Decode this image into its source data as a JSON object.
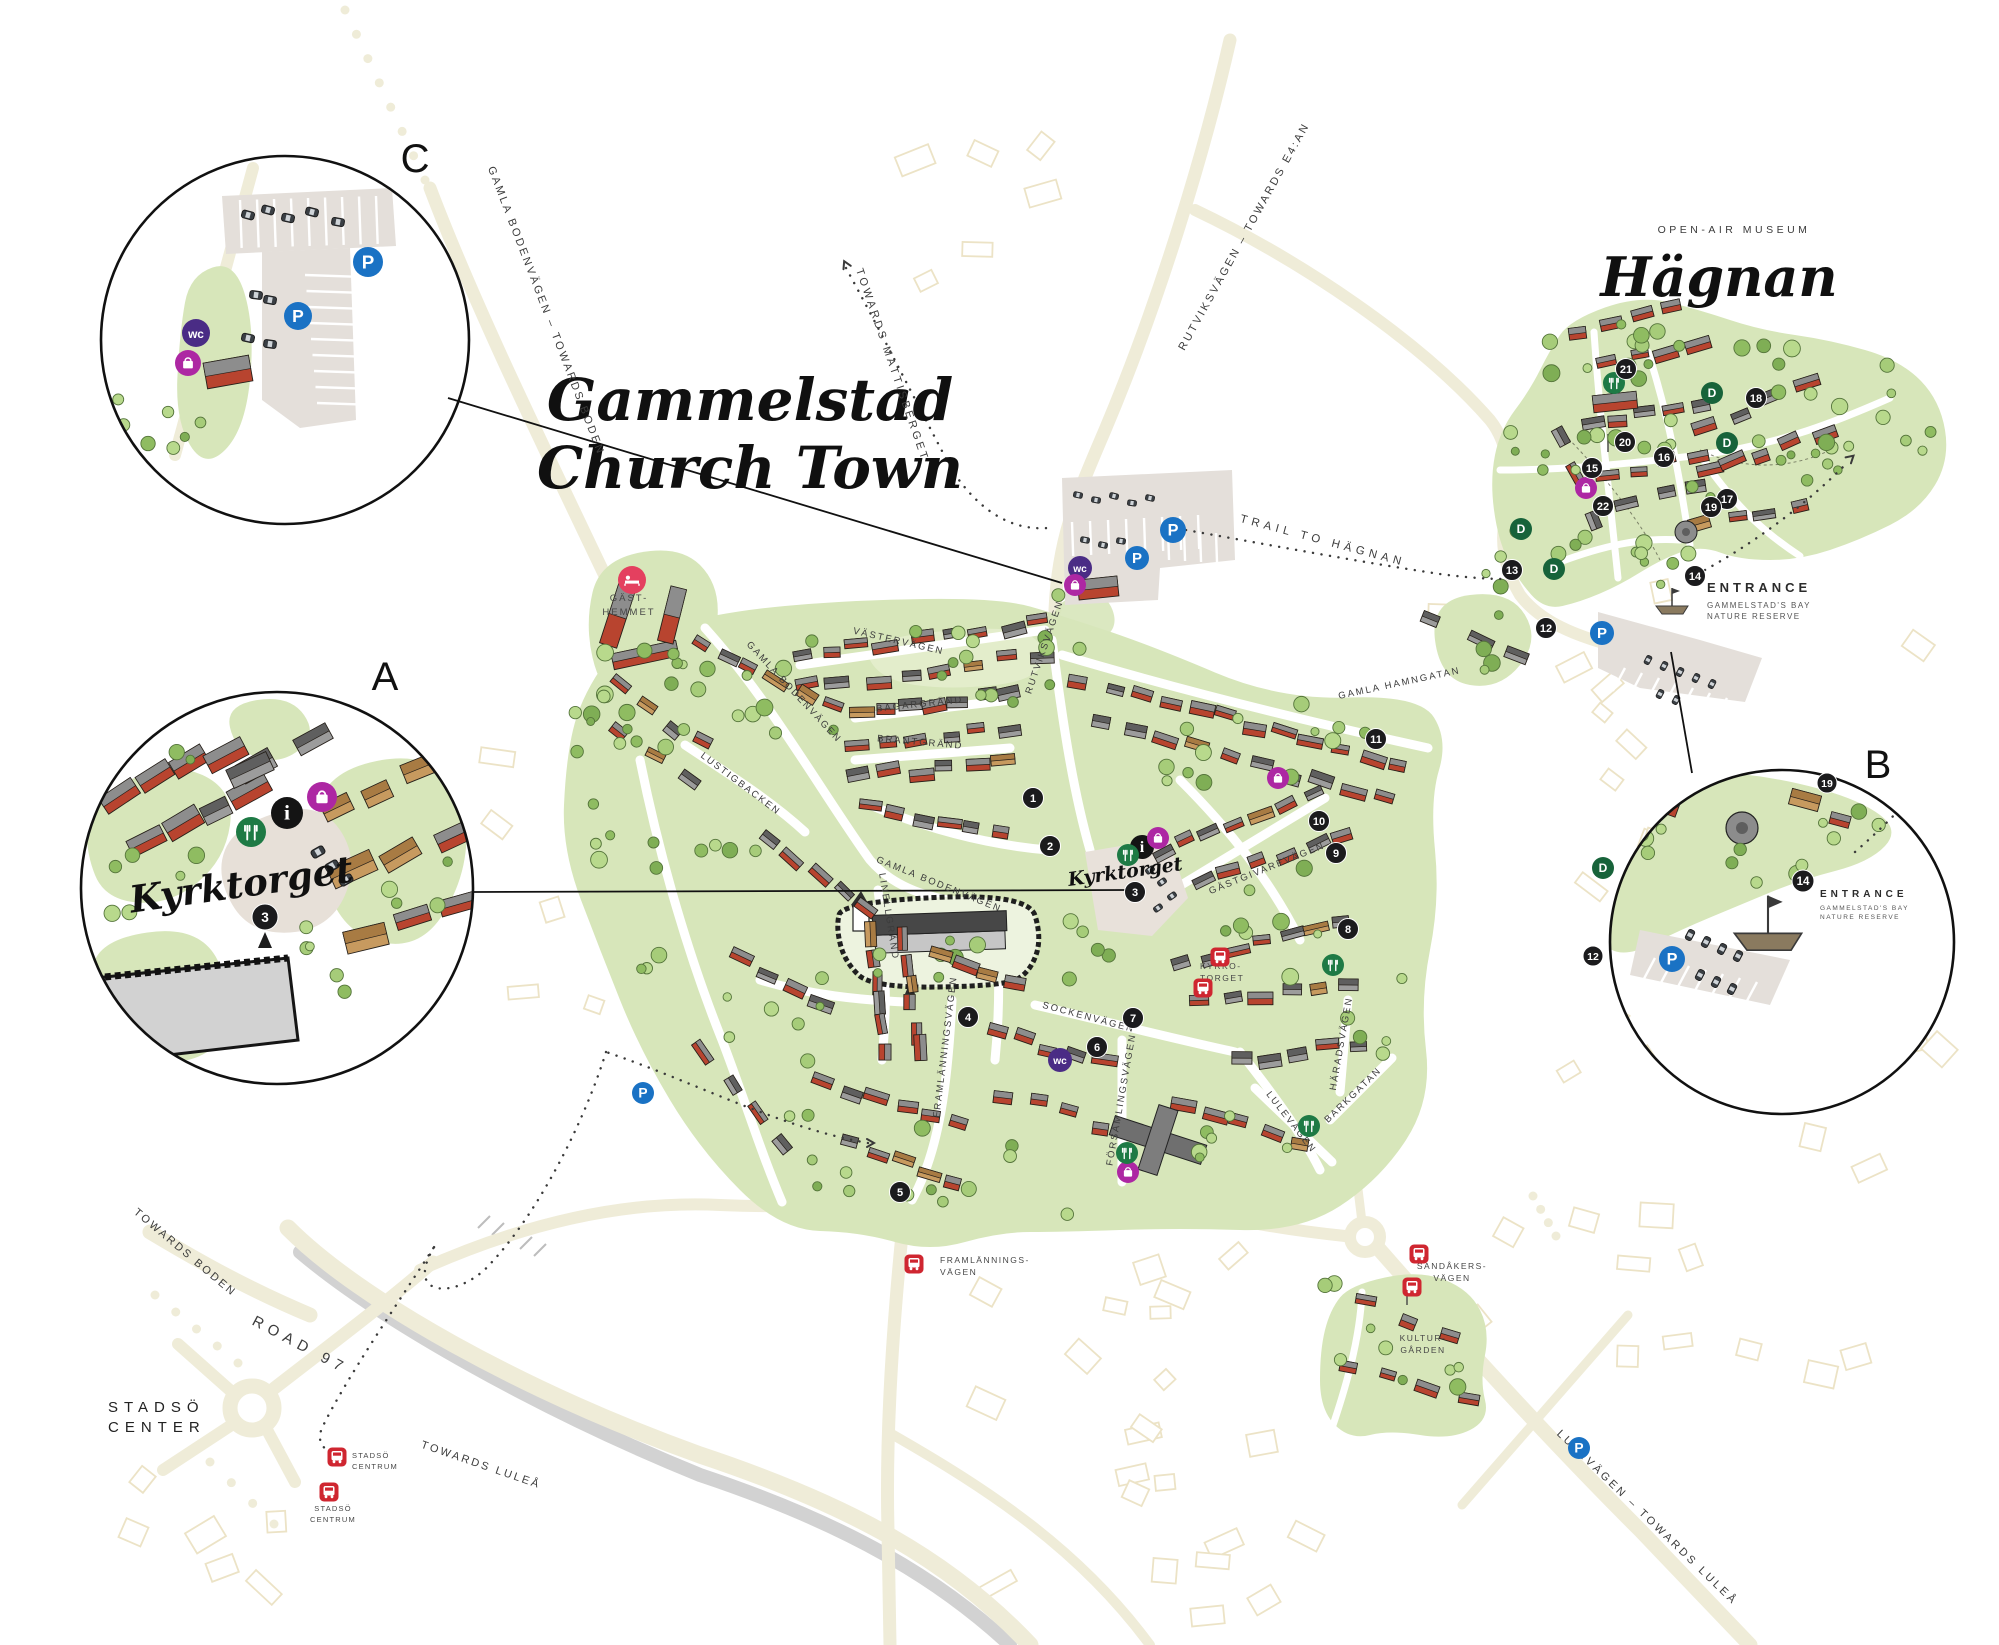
{
  "title": {
    "line1": "Gammelstad",
    "line2": "Church Town"
  },
  "museum": {
    "kicker": "OPEN-AIR MUSEUM",
    "name": "Hägnan"
  },
  "plaza": {
    "name": "Kyrktorget"
  },
  "insets": [
    {
      "id": "A",
      "label": "A",
      "caption": "Kyrktorget"
    },
    {
      "id": "B",
      "label": "B"
    },
    {
      "id": "C",
      "label": "C"
    }
  ],
  "entrance": {
    "title": "ENTRANCE",
    "line1": "GAMMELSTAD'S BAY",
    "line2": "NATURE RESERVE"
  },
  "road_labels": [
    {
      "text": "GAMLA BODENVÄGEN – TOWARDS BODEN",
      "x": 543,
      "y": 312,
      "rot": 69,
      "size": 11,
      "ls": 2.5
    },
    {
      "text": "TOWARDS MATTISBERGET",
      "x": 889,
      "y": 366,
      "rot": 71,
      "size": 11,
      "ls": 3
    },
    {
      "text": "RUTVIKSVÄGEN – TOWARDS E4:AN",
      "x": 1247,
      "y": 238,
      "rot": -61,
      "size": 11,
      "ls": 2.5
    },
    {
      "text": "TRAIL TO HÄGNAN",
      "x": 1322,
      "y": 544,
      "rot": 15,
      "size": 11.5,
      "ls": 4.5
    },
    {
      "text": "GAMLA HAMNGATAN",
      "x": 1400,
      "y": 686,
      "rot": -12,
      "size": 9.5,
      "ls": 2
    },
    {
      "text": "VÄSTERVÄGEN",
      "x": 898,
      "y": 644,
      "rot": 13,
      "size": 9.5,
      "ls": 2
    },
    {
      "text": "GAMLA BODENVÄGEN",
      "x": 792,
      "y": 694,
      "rot": 47,
      "size": 9.5,
      "ls": 2
    },
    {
      "text": "BAGARGRÄND",
      "x": 920,
      "y": 707,
      "rot": -6,
      "size": 9.5,
      "ls": 2
    },
    {
      "text": "BRANTGRÄND",
      "x": 920,
      "y": 745,
      "rot": 5,
      "size": 9.5,
      "ls": 2
    },
    {
      "text": "RUTVIKSVÄGEN",
      "x": 1047,
      "y": 648,
      "rot": -71,
      "size": 9.5,
      "ls": 2
    },
    {
      "text": "LUSTIGBACKEN",
      "x": 739,
      "y": 786,
      "rot": 37,
      "size": 9.5,
      "ls": 2
    },
    {
      "text": "GAMLA BODENVÄGEN",
      "x": 938,
      "y": 887,
      "rot": 22,
      "size": 9.5,
      "ls": 2
    },
    {
      "text": "LINELLGRÄND",
      "x": 886,
      "y": 917,
      "rot": 81,
      "size": 9.5,
      "ls": 2
    },
    {
      "text": "SOCKENVÄGEN",
      "x": 1088,
      "y": 1020,
      "rot": 15,
      "size": 9.5,
      "ls": 2
    },
    {
      "text": "FÖRSAMLINGSVÄGEN",
      "x": 1124,
      "y": 1100,
      "rot": -80,
      "size": 9.5,
      "ls": 2
    },
    {
      "text": "FRAMLÄNNINGSVÄGEN",
      "x": 948,
      "y": 1047,
      "rot": -83,
      "size": 9.5,
      "ls": 2
    },
    {
      "text": "HÄRADSVÄGEN",
      "x": 1344,
      "y": 1044,
      "rot": -80,
      "size": 9.5,
      "ls": 2
    },
    {
      "text": "BARKGATAN",
      "x": 1355,
      "y": 1097,
      "rot": -44,
      "size": 9.5,
      "ls": 2
    },
    {
      "text": "LULEVÄGEN",
      "x": 1289,
      "y": 1124,
      "rot": 52,
      "size": 9.5,
      "ls": 2
    },
    {
      "text": "GÄSTGIVAREVÄGEN",
      "x": 1268,
      "y": 871,
      "rot": -22,
      "size": 9.5,
      "ls": 2
    },
    {
      "text": "LULEVÄGEN – TOWARDS LULEÅ",
      "x": 1645,
      "y": 1520,
      "rot": 44,
      "size": 11,
      "ls": 3
    },
    {
      "text": "TOWARDS BODEN",
      "x": 183,
      "y": 1255,
      "rot": 40,
      "size": 11,
      "ls": 2.5
    },
    {
      "text": "ROAD 97",
      "x": 298,
      "y": 1349,
      "rot": 28,
      "size": 15,
      "ls": 6
    },
    {
      "text": "TOWARDS LULEÅ",
      "x": 480,
      "y": 1468,
      "rot": 19,
      "size": 11,
      "ls": 2.5
    }
  ],
  "place_labels": [
    {
      "lines": [
        "GÄST-",
        "HEMMET"
      ],
      "x": 629,
      "y": 601,
      "lh": 14,
      "size": 9.5,
      "ls": 2,
      "anchor": "middle"
    },
    {
      "lines": [
        "KYRKO-",
        "TORGET"
      ],
      "x": 1200,
      "y": 969,
      "lh": 12,
      "size": 8.5,
      "ls": 1.5,
      "anchor": "start"
    },
    {
      "lines": [
        "FRAMLÄNNINGS-",
        "VÄGEN"
      ],
      "x": 940,
      "y": 1263,
      "lh": 12,
      "size": 8.5,
      "ls": 1.5,
      "anchor": "start"
    },
    {
      "lines": [
        "SANDÅKERS-",
        "VÄGEN"
      ],
      "x": 1452,
      "y": 1269,
      "lh": 12,
      "size": 8.5,
      "ls": 1.5,
      "anchor": "middle"
    },
    {
      "lines": [
        "KULTUR-",
        "GÅRDEN"
      ],
      "x": 1423,
      "y": 1341,
      "lh": 12,
      "size": 8.5,
      "ls": 1.5,
      "anchor": "middle"
    },
    {
      "lines": [
        "STADSÖ",
        "CENTRUM"
      ],
      "x": 352,
      "y": 1458,
      "lh": 11,
      "size": 7.5,
      "ls": 1.2,
      "anchor": "start"
    },
    {
      "lines": [
        "STADSÖ",
        "CENTRUM"
      ],
      "x": 333,
      "y": 1511,
      "lh": 11,
      "size": 7.5,
      "ls": 1.2,
      "anchor": "middle"
    },
    {
      "lines": [
        "STADSÖ",
        "CENTER"
      ],
      "x": 108,
      "y": 1412,
      "lh": 20,
      "size": 15,
      "ls": 6,
      "anchor": "start",
      "color": "#222222"
    }
  ],
  "markers": [
    {
      "n": "1",
      "x": 1033,
      "y": 798
    },
    {
      "n": "2",
      "x": 1050,
      "y": 846
    },
    {
      "n": "3",
      "x": 1135,
      "y": 892
    },
    {
      "n": "4",
      "x": 968,
      "y": 1017
    },
    {
      "n": "5",
      "x": 900,
      "y": 1192
    },
    {
      "n": "6",
      "x": 1097,
      "y": 1047
    },
    {
      "n": "7",
      "x": 1133,
      "y": 1018
    },
    {
      "n": "8",
      "x": 1348,
      "y": 929
    },
    {
      "n": "9",
      "x": 1336,
      "y": 853
    },
    {
      "n": "10",
      "x": 1319,
      "y": 821
    },
    {
      "n": "11",
      "x": 1376,
      "y": 739
    },
    {
      "n": "12",
      "x": 1546,
      "y": 628
    },
    {
      "n": "13",
      "x": 1512,
      "y": 570
    },
    {
      "n": "14",
      "x": 1695,
      "y": 576
    },
    {
      "n": "15",
      "x": 1592,
      "y": 468
    },
    {
      "n": "16",
      "x": 1664,
      "y": 457
    },
    {
      "n": "17",
      "x": 1727,
      "y": 499
    },
    {
      "n": "18",
      "x": 1756,
      "y": 398
    },
    {
      "n": "19",
      "x": 1711,
      "y": 507
    },
    {
      "n": "20",
      "x": 1625,
      "y": 442
    },
    {
      "n": "21",
      "x": 1626,
      "y": 369
    },
    {
      "n": "22",
      "x": 1603,
      "y": 506
    }
  ],
  "inset_markers": [
    {
      "n": "3",
      "x": 265,
      "y": 917,
      "r": 13
    },
    {
      "n": "19",
      "x": 1827,
      "y": 783,
      "r": 10
    },
    {
      "n": "14",
      "x": 1803,
      "y": 881,
      "r": 11
    },
    {
      "n": "12",
      "x": 1593,
      "y": 956,
      "r": 10
    }
  ],
  "d_markers": [
    {
      "x": 1521,
      "y": 529
    },
    {
      "x": 1554,
      "y": 569
    },
    {
      "x": 1712,
      "y": 393
    },
    {
      "x": 1727,
      "y": 443
    },
    {
      "x": 1603,
      "y": 868
    }
  ],
  "icons": {
    "parking": [
      [
        1173,
        530,
        13
      ],
      [
        1137,
        558,
        12
      ],
      [
        1602,
        633,
        12
      ],
      [
        643,
        1093,
        11
      ],
      [
        1579,
        1448,
        11
      ],
      [
        368,
        262,
        15
      ],
      [
        298,
        316,
        14
      ],
      [
        1672,
        959,
        13
      ]
    ],
    "wc": [
      [
        1080,
        568,
        12
      ],
      [
        1060,
        1060,
        12
      ],
      [
        196,
        333,
        14
      ]
    ],
    "shop": [
      [
        1075,
        585,
        11
      ],
      [
        1158,
        838,
        11
      ],
      [
        1278,
        778,
        11
      ],
      [
        1128,
        1172,
        11
      ],
      [
        1586,
        488,
        11
      ],
      [
        322,
        797,
        15
      ],
      [
        188,
        363,
        13
      ]
    ],
    "restaurant": [
      [
        1128,
        855,
        11
      ],
      [
        1333,
        965,
        11
      ],
      [
        1309,
        1126,
        11
      ],
      [
        1127,
        1153,
        11
      ],
      [
        1614,
        383,
        11
      ],
      [
        251,
        832,
        15
      ]
    ],
    "info": [
      [
        1142,
        847,
        12
      ],
      [
        287,
        813,
        16
      ]
    ],
    "bed": [
      [
        632,
        580,
        14
      ]
    ]
  },
  "glyphs": {
    "parking": "P",
    "wc": "wc",
    "info": "i",
    "d": "D"
  },
  "bus_stops": [
    {
      "x": 1220,
      "y": 957
    },
    {
      "x": 1203,
      "y": 988
    },
    {
      "x": 914,
      "y": 1264
    },
    {
      "x": 1419,
      "y": 1254
    },
    {
      "x": 1412,
      "y": 1287
    },
    {
      "x": 337,
      "y": 1457
    },
    {
      "x": 329,
      "y": 1492
    }
  ],
  "colors": {
    "road": "#efecd8",
    "road_gray": "#d2d2d2",
    "green": "#d7e6ba",
    "green_light": "#e6efd0",
    "tree_stroke": "#54743a",
    "building_red": "#b8442f",
    "building_gray": "#9c9c9c",
    "building_tan": "#c79a5f",
    "parking_fill": "#e4dfda",
    "marker": "#1b1b1d",
    "d_marker": "#17633a",
    "p_blue": "#1a72c4",
    "wc_purple": "#4a2c85",
    "shop_magenta": "#ad27a3",
    "restaurant_green": "#1e7a45",
    "bus_red": "#cf2630",
    "bed_pink": "#e4405f",
    "label": "#3c3c3c",
    "faint": "#ece3c6"
  }
}
